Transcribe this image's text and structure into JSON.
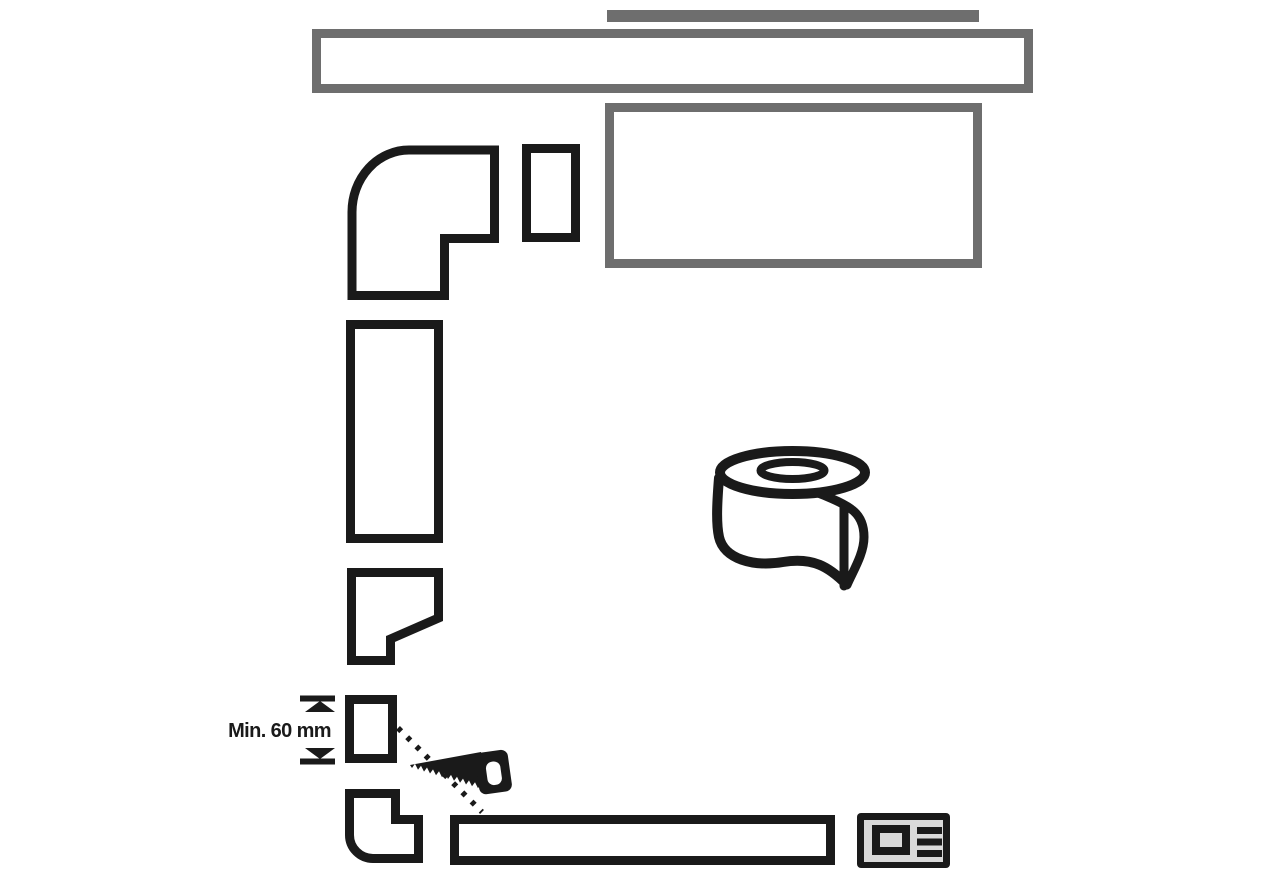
{
  "page": {
    "type": "appliance-duct-installation-diagram",
    "background": "#ffffff"
  },
  "diagram": {
    "dimension_label": "Min. 60 mm",
    "colors": {
      "outline_black": "#1a1a1a",
      "structure_gray": "#6e6e6e",
      "plate_fill_gray": "#d9d9d9",
      "background": "#ffffff"
    },
    "parts": [
      {
        "name": "wall-strip-gray-bar"
      },
      {
        "name": "countertop-panel"
      },
      {
        "name": "cabinet-side-panel"
      },
      {
        "name": "elbow-duct-top"
      },
      {
        "name": "duct-connector-piece"
      },
      {
        "name": "straight-duct-section"
      },
      {
        "name": "transition-duct-piece"
      },
      {
        "name": "min-height-dimension"
      },
      {
        "name": "cut-duct-piece"
      },
      {
        "name": "cut-line-dotted"
      },
      {
        "name": "handsaw-icon"
      },
      {
        "name": "elbow-duct-bottom"
      },
      {
        "name": "horizontal-duct-section"
      },
      {
        "name": "tape-roll-icon"
      },
      {
        "name": "rating-plate-icon"
      }
    ]
  }
}
